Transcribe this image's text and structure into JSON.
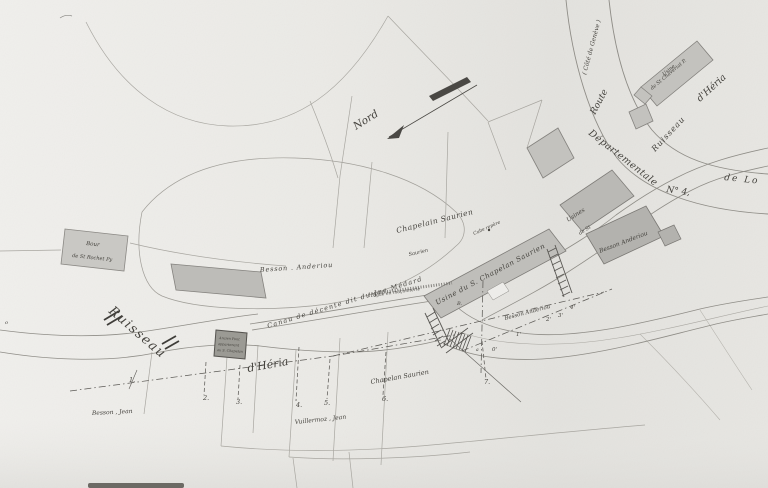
{
  "colors": {
    "paper": "#edece9",
    "paper_shade": "#e1e0dc",
    "ink": "#45433e",
    "line": "#8f8d87",
    "building_fill": "#c3c2be",
    "building_dark": "#b3b2ae",
    "bridge_dark": "#9b9a94"
  },
  "compass": {
    "north_label": "Nord"
  },
  "roads": {
    "cote_label": "( Côté de Genève )",
    "route_label": "Route",
    "departementale_label": "Départementale",
    "number_label": "N° 4,",
    "destination_label": "de  Lo"
  },
  "streams": {
    "ruisseau_ne": "Ruisseau",
    "heria_ne": "d'Héria",
    "ruisseau_w": "Ruisseau",
    "heria_w": "d'Héria",
    "canal_label": "Canau de décente dit du Jne Médard",
    "digue_label": "Digue en maçonnerie",
    "chapelan_stream_label": "Chapelan Saurien"
  },
  "buildings": {
    "chaveriat_line1": "Usine",
    "chaveriat_line2": "de St Chavériat P.",
    "usines_line1": "Usines",
    "usines_line2": "de St",
    "chapelan_mill_label": "Usine du S. Chapelan Saurien",
    "bour_line1": "Bour",
    "bour_line2": "de St Rochet Py",
    "bridge_line1": "Ancien Pont",
    "bridge_line2": "appartenant",
    "bridge_line3": "au S. Chapelan",
    "repere_label": "Cube repère"
  },
  "owners": {
    "besson_anderiou_east": "Besson Anderiou",
    "besson_anderiou_center": "Besson . Anderiou",
    "besson_anderiou_stream": "Besson Anderiou",
    "chapelain_saurien": "Chapelain Saurien",
    "saurien": "Saurien",
    "besson_jean": "Besson , Jean",
    "vuillermoz_jean": "Vuillermoz , Jean"
  },
  "survey_points": {
    "p1": "1.",
    "p2": "2.",
    "p3": "3.",
    "p4": "4.",
    "p5": "5.",
    "p6": "6.",
    "p7": "7.",
    "q0": "0'",
    "q1": "1'",
    "q2": "2'",
    "q3": "3'",
    "q4": "4'",
    "b": "B.",
    "a": "a",
    "o": "o"
  }
}
